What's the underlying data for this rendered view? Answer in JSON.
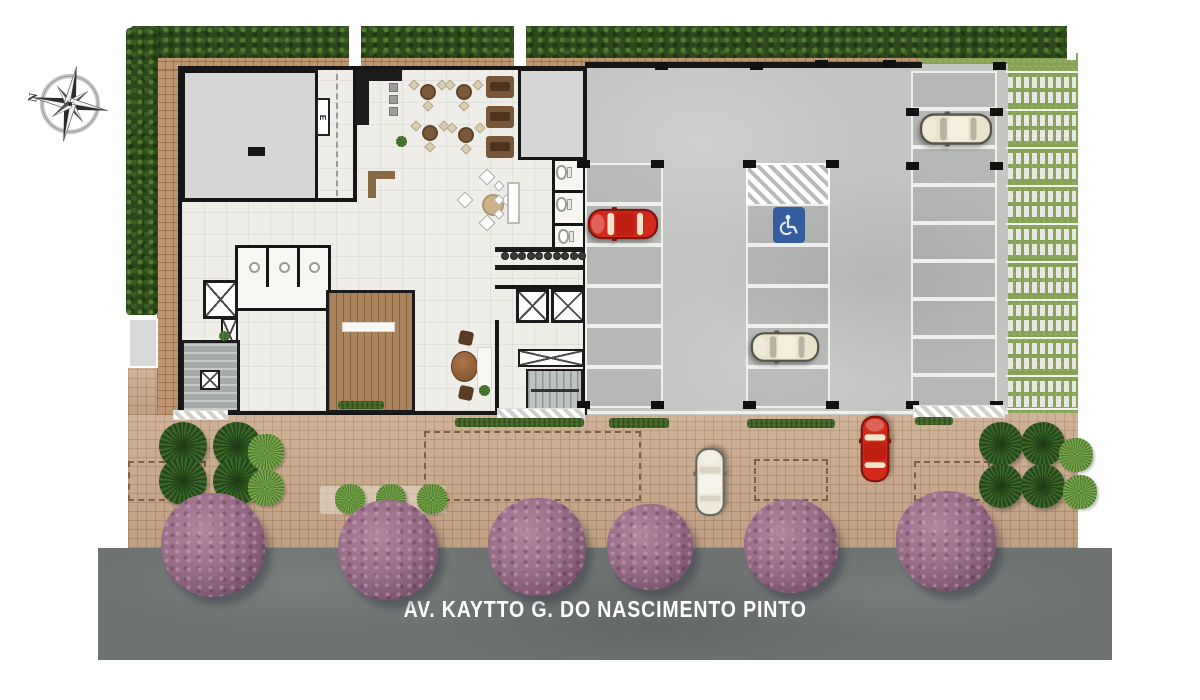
{
  "meta": {
    "type": "architectural-site-plan",
    "view": "top-down ground floor / implantation plan"
  },
  "street": {
    "name": "AV. KAYTTO G. DO NASCIMENTO PINTO",
    "label_color": "#ffffff",
    "surface_color": "#6f7473"
  },
  "compass": {
    "north_label": "N"
  },
  "building": {
    "electrical_label": "E"
  },
  "accessibility": {
    "icon": "wheelchair-icon",
    "sign_color": "#2b5ca8"
  },
  "palette": {
    "hedge": "#2c491c",
    "lawn": "#86a355",
    "paver_grass": "#7d9747",
    "paver_block": "#e8e8e2",
    "sidewalk_brick": "#c8a687",
    "border_brick": "#bd9670",
    "concrete": "#c4c6c4",
    "wall": "#161616",
    "floor": "#efede7",
    "gray_room": "#d6d6d5",
    "deck_wood": "#a8835c",
    "street_asphalt": "#6f7473",
    "tree_purple": "#9a6d88",
    "accent_blue": "#2b5ca8"
  },
  "car_colors": {
    "red": {
      "body": "#d2291c",
      "outline": "#7e150e",
      "roof": "#c01f13",
      "glass": "#f1e7cd"
    },
    "beige": {
      "body": "#eae3cb",
      "outline": "#55534a",
      "roof": "#f4efdd",
      "glass": "#b9b2a0"
    },
    "white": {
      "body": "#eee9d9",
      "outline": "#6a6a64",
      "roof": "#f6f3e8",
      "glass": "#d8d3c2"
    }
  },
  "scene": {
    "cars": [
      {
        "kind": "red",
        "x": 586,
        "y": 203,
        "len": 74,
        "wid": 41,
        "dir": "left"
      },
      {
        "kind": "beige",
        "x": 916,
        "y": 110,
        "len": 80,
        "wid": 38,
        "dir": "left"
      },
      {
        "kind": "beige",
        "x": 746,
        "y": 329,
        "len": 78,
        "wid": 36,
        "dir": "left"
      },
      {
        "kind": "white",
        "x": 692,
        "y": 442,
        "len": 80,
        "wid": 36,
        "dir": "up"
      },
      {
        "kind": "red",
        "x": 857,
        "y": 410,
        "len": 78,
        "wid": 35,
        "dir": "up"
      }
    ],
    "trees": [
      [
        213,
        545,
        52
      ],
      [
        388,
        550,
        50
      ],
      [
        537,
        547,
        49
      ],
      [
        650,
        547,
        43
      ],
      [
        791,
        546,
        47
      ],
      [
        946,
        541,
        50
      ]
    ],
    "parking_columns": [
      {
        "x": 585,
        "w": 78,
        "bounds": [
          163,
          204,
          245,
          286,
          326,
          367,
          408
        ]
      },
      {
        "x": 746,
        "w": 84,
        "bounds": [
          163,
          204,
          245,
          286,
          326,
          367,
          408
        ],
        "hatch": 0
      },
      {
        "x": 911,
        "w": 86,
        "bounds": [
          71,
          109,
          147,
          185,
          223,
          261,
          299,
          337,
          375,
          408
        ]
      }
    ],
    "paver_rows_y": [
      71,
      109,
      147,
      185,
      223,
      261,
      299,
      337,
      375,
      408
    ],
    "col_marks": [
      [
        577,
        160
      ],
      [
        651,
        160
      ],
      [
        743,
        160
      ],
      [
        826,
        160
      ],
      [
        906,
        162
      ],
      [
        990,
        162
      ],
      [
        577,
        401
      ],
      [
        651,
        401
      ],
      [
        743,
        401
      ],
      [
        826,
        401
      ],
      [
        906,
        401
      ],
      [
        990,
        401
      ],
      [
        655,
        62
      ],
      [
        750,
        62
      ],
      [
        815,
        60
      ],
      [
        883,
        60
      ],
      [
        993,
        62
      ],
      [
        906,
        108
      ],
      [
        990,
        108
      ]
    ],
    "hedge_segments": [
      [
        455,
        418,
        129,
        9
      ],
      [
        609,
        418,
        60,
        10
      ],
      [
        747,
        419,
        88,
        9
      ],
      [
        915,
        417,
        38,
        8
      ]
    ],
    "dashed_rects": [
      [
        424,
        431,
        217,
        70
      ],
      [
        754,
        459,
        74,
        42
      ],
      [
        914,
        461,
        76,
        40
      ],
      [
        128,
        461,
        78,
        40
      ]
    ],
    "aprons": [
      [
        497,
        408,
        88,
        12
      ],
      [
        913,
        405,
        92,
        13
      ],
      [
        173,
        410,
        55,
        10
      ]
    ],
    "bed_left_clumps": [
      [
        183,
        446,
        48
      ],
      [
        237,
        446,
        48
      ],
      [
        183,
        481,
        48
      ],
      [
        237,
        481,
        48
      ]
    ],
    "bed_left_palms": [
      [
        266,
        452,
        36
      ],
      [
        266,
        488,
        36
      ]
    ],
    "bed_right_clumps": [
      [
        1001,
        444,
        44
      ],
      [
        1043,
        444,
        44
      ],
      [
        1001,
        486,
        44
      ],
      [
        1043,
        486,
        44
      ]
    ],
    "bed_right_palms": [
      [
        1076,
        455,
        34
      ],
      [
        1080,
        492,
        34
      ]
    ],
    "palm_strip": [
      [
        350,
        499,
        30
      ],
      [
        391,
        499,
        30
      ],
      [
        432,
        499,
        30
      ]
    ],
    "terrace_tables": [
      [
        428,
        92
      ],
      [
        464,
        92
      ],
      [
        430,
        133
      ],
      [
        466,
        135
      ]
    ],
    "booths": [
      [
        486,
        76
      ],
      [
        486,
        106
      ],
      [
        486,
        136
      ]
    ],
    "dining_chairs": [
      [
        487,
        177
      ],
      [
        487,
        223
      ],
      [
        465,
        200
      ],
      [
        509,
        200
      ]
    ],
    "high_chairs": [
      [
        499,
        186
      ],
      [
        499,
        200
      ],
      [
        499,
        214
      ]
    ],
    "desk_chairs": [
      [
        459,
        331
      ],
      [
        459,
        386
      ]
    ],
    "stools": {
      "x0": 501,
      "y": 252,
      "n": 10,
      "dx": 8.6
    },
    "sinks": [
      [
        249,
        262
      ],
      [
        279,
        262
      ],
      [
        309,
        262
      ]
    ],
    "toilets": [
      [
        556,
        165
      ],
      [
        556,
        197
      ],
      [
        558,
        229
      ]
    ],
    "appliances": [
      [
        389,
        83
      ],
      [
        389,
        95
      ],
      [
        389,
        107
      ]
    ],
    "plant_tufts": [
      [
        401,
        141,
        11
      ],
      [
        484,
        390,
        11
      ],
      [
        224,
        336,
        10
      ]
    ]
  }
}
